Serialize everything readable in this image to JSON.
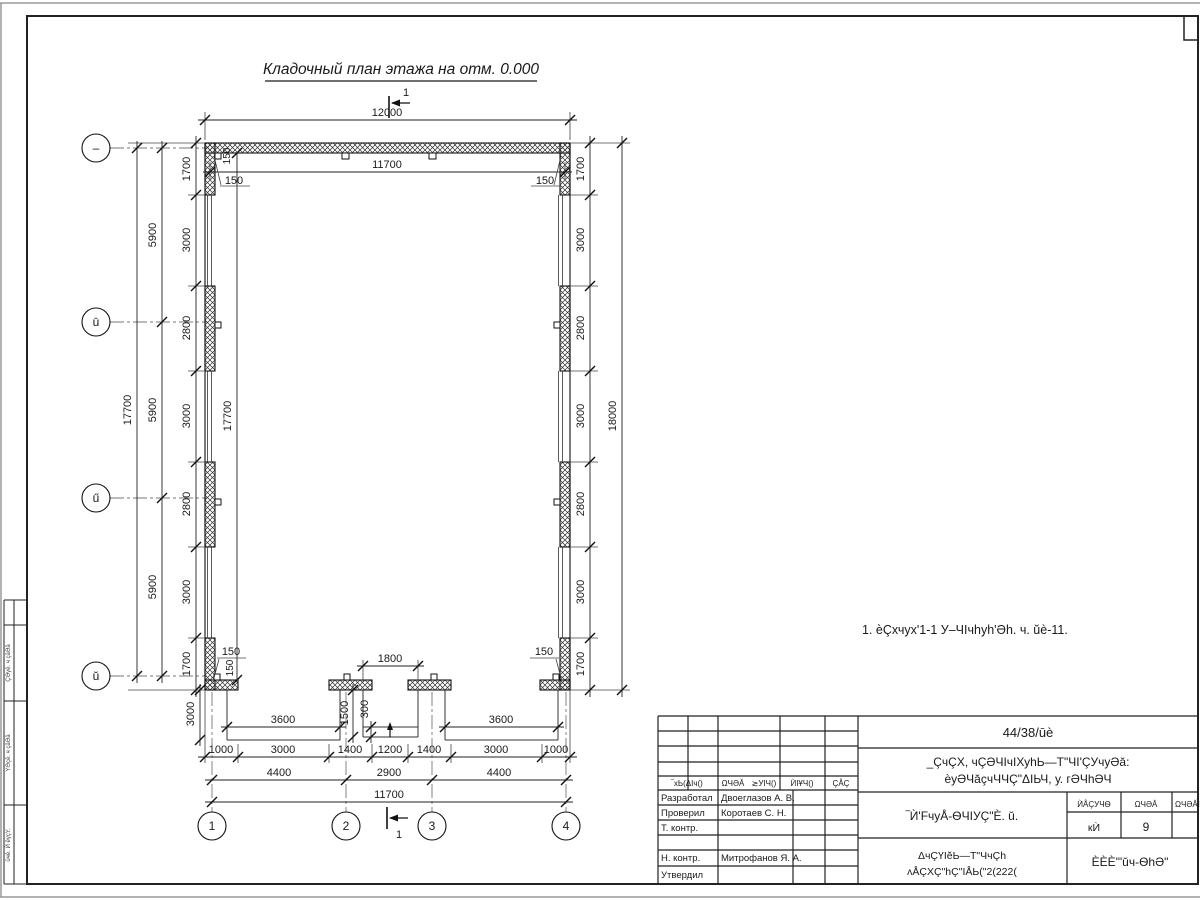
{
  "title": "Кладочный план этажа на отм. 0.000",
  "note": "1. ѐÇхчух'1-1 У‒ЧIчhуh'Əh. ч. ŭè-11.",
  "plan": {
    "section_label": "1",
    "axes": {
      "left_labels": [
        "–",
        "ū",
        "ű",
        "ŭ"
      ],
      "bottom_labels": [
        "1",
        "2",
        "3",
        "4"
      ]
    },
    "dims": {
      "top_total": "12000",
      "top_inner": "11700",
      "left_total": "17700",
      "left_axis_spacing": [
        "5900",
        "5900",
        "5900"
      ],
      "side_chain": [
        "1700",
        "3000",
        "2800",
        "3000",
        "2800",
        "3000",
        "1700"
      ],
      "interior_height": "17700",
      "right_total": "18000",
      "bottom_chain": [
        "1000",
        "3000",
        "1400",
        "1200",
        "1400",
        "3000",
        "1000"
      ],
      "bottom_axis_spacing": [
        "4400",
        "2900",
        "4400"
      ],
      "bottom_total": "11700",
      "ramp_width": "3600",
      "porch_opening": "1800",
      "porch_depth": "1500",
      "step_depth": "300",
      "apron_depth": "3000",
      "axis_offset": "150"
    }
  },
  "title_block": {
    "doc_code": "44/38/ūè",
    "project_line1": "_ÇчÇХ, чÇƏЧIчIХуhЬ—Т\"ЧI'ÇУчуƏă:",
    "project_line2": "ѐуƏЧăçчЧЧÇ\"ΔIЬЧ, у. гƏЧhƏЧ",
    "sheet_title": "‾Ѝ'FчуÅ-ѲЧIУÇ\"È. ŭ.",
    "stage_header": "ЍÅÇУЧѲ",
    "sheet_header": "ΩЧƏĂ",
    "sheets_header": "ΩЧƏĂIУ",
    "stage_value": "кЍ",
    "sheet_value": "9",
    "org_line1": "ΔчÇҮIĕЬ—Т\"ЧчÇh",
    "org_line2": "ʌÅÇХÇ\"hÇ\"IÅЬ(\"2(222(",
    "firm": "ÈÈÈ'\"ŭч-ѲhƏ\"",
    "rev_headers": [
      "‾хЬ(ΔIч()",
      "ΩЧƏĂ",
      "≳УIЧ()",
      "ЍIҰЧ()",
      "ÇÅÇ"
    ],
    "roles": [
      "Разработал",
      "Проверил",
      "Т. контр.",
      "Н. контр.",
      "Утвердил"
    ],
    "names": [
      "Двоеглазов А. В.",
      "Коротаев С. Н.",
      "Митрофанов Я. А."
    ]
  },
  "margin_labels": [
    "ÇƏγĕ. ч çăƏă",
    "ΥƏçĕ. ч çăƏă",
    "ŭчĕ. Ѝ ĕγçΥ."
  ]
}
